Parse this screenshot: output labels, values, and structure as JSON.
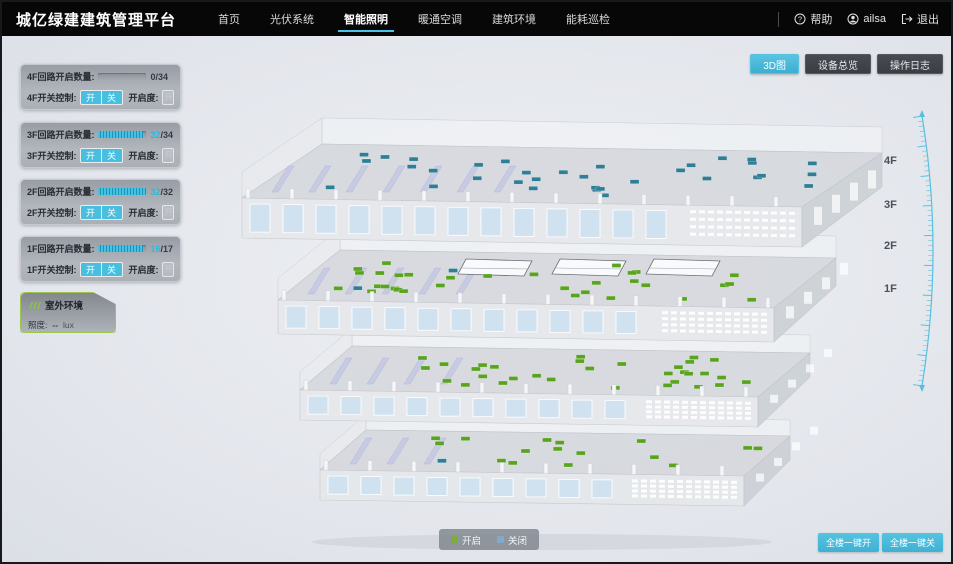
{
  "app": {
    "title": "城亿绿建建筑管理平台"
  },
  "header": {
    "nav": [
      {
        "label": "首页",
        "active": false
      },
      {
        "label": "光伏系统",
        "active": false
      },
      {
        "label": "智能照明",
        "active": true
      },
      {
        "label": "暖通空调",
        "active": false
      },
      {
        "label": "建筑环境",
        "active": false
      },
      {
        "label": "能耗巡检",
        "active": false
      }
    ],
    "help_label": "帮助",
    "user_name": "ailsa",
    "logout_label": "退出"
  },
  "view_buttons": [
    {
      "label": "3D图",
      "active": true
    },
    {
      "label": "设备总览",
      "active": false
    },
    {
      "label": "操作日志",
      "active": false
    }
  ],
  "floor_panels": [
    {
      "floor": "4F",
      "circuit_label": "4F回路开启数量:",
      "open": 0,
      "total": 34,
      "switch_label": "4F开关控制:",
      "on_label": "开",
      "off_label": "关",
      "openness_label": "开启度:",
      "openness_placeholder": "开启度",
      "unit": "%"
    },
    {
      "floor": "3F",
      "circuit_label": "3F回路开启数量:",
      "open": 32,
      "total": 34,
      "switch_label": "3F开关控制:",
      "on_label": "开",
      "off_label": "关",
      "openness_label": "开启度:",
      "openness_placeholder": "开启度",
      "unit": "%"
    },
    {
      "floor": "2F",
      "circuit_label": "2F回路开启数量:",
      "open": 32,
      "total": 32,
      "switch_label": "2F开关控制:",
      "on_label": "开",
      "off_label": "关",
      "openness_label": "开启度:",
      "openness_placeholder": "开启度",
      "unit": "%"
    },
    {
      "floor": "1F",
      "circuit_label": "1F回路开启数量:",
      "open": 16,
      "total": 17,
      "switch_label": "1F开关控制:",
      "on_label": "开",
      "off_label": "关",
      "openness_label": "开启度:",
      "openness_placeholder": "开启度",
      "unit": "%"
    }
  ],
  "outdoor_panel": {
    "title": "室外环境",
    "illuminance_label": "照度:",
    "illuminance_value": "--",
    "illuminance_unit": "lux"
  },
  "floor_labels": [
    "4F",
    "3F",
    "2F",
    "1F"
  ],
  "legend": {
    "items": [
      {
        "label": "开启",
        "color": "#7bab41"
      },
      {
        "label": "关闭",
        "color": "#87a9c9"
      }
    ]
  },
  "footer_buttons": [
    {
      "label": "全楼一键开"
    },
    {
      "label": "全楼一键关"
    }
  ],
  "building": {
    "floors": [
      {
        "name": "4F",
        "open": 0,
        "closed": 34
      },
      {
        "name": "3F",
        "open": 32,
        "closed": 2
      },
      {
        "name": "2F",
        "open": 32,
        "closed": 0
      },
      {
        "name": "1F",
        "open": 16,
        "closed": 1
      }
    ],
    "open_color": "#58a41e",
    "closed_color": "#2e7e95"
  },
  "colors": {
    "accent": "#45c5e6"
  }
}
